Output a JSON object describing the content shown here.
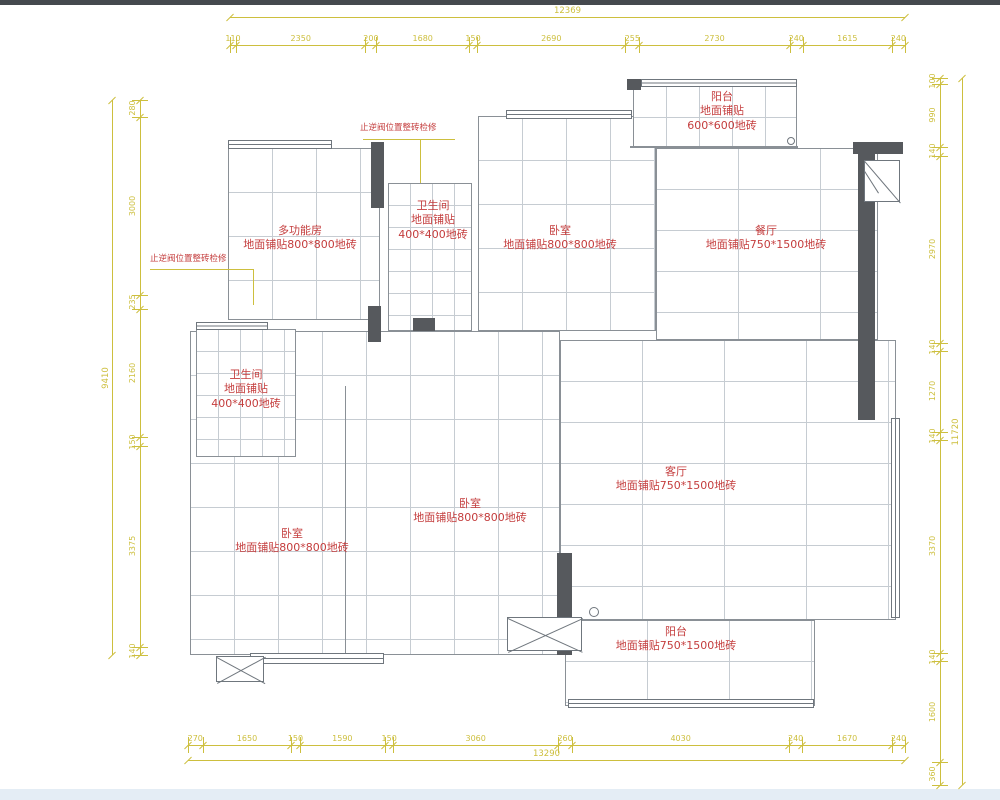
{
  "colors": {
    "dim": "#cdbf3e",
    "label": "#c43d3d",
    "wall": "#56595d",
    "grid": "#c6ccd2",
    "border": "#8a9096",
    "window_line": "#6f767d",
    "page_top_bar": "#45494e",
    "page_bottom_strip": "#e4edf5"
  },
  "dims": {
    "top": {
      "overall": "12369",
      "segments": [
        "110",
        "2350",
        "200",
        "1680",
        "150",
        "2690",
        "255",
        "2730",
        "240",
        "1615",
        "240"
      ],
      "x0": 230,
      "x1": 905,
      "seg_y": 45,
      "ov_y": 17
    },
    "bottom": {
      "overall": "13290",
      "segments": [
        "270",
        "1650",
        "150",
        "1590",
        "150",
        "3060",
        "260",
        "4030",
        "240",
        "1670",
        "240"
      ],
      "x0": 188,
      "x1": 905,
      "seg_y": 745,
      "ov_y": 760
    },
    "left": {
      "overall": "9410",
      "segments": [
        "280",
        "3000",
        "235",
        "2160",
        "150",
        "3375",
        "140"
      ],
      "y0": 100,
      "y1": 655,
      "seg_x": 140,
      "ov_x": 112
    },
    "right": {
      "overall": "11720",
      "segments": [
        "100",
        "990",
        "140",
        "2970",
        "140",
        "1270",
        "140",
        "3370",
        "140",
        "1600",
        "360"
      ],
      "y0": 78,
      "y1": 785,
      "seg_x": 940,
      "ov_x": 962
    }
  },
  "rooms": [
    {
      "id": "multi-function-room",
      "tile": "800*800",
      "x": 228,
      "y": 148,
      "w": 152,
      "h": 172
    },
    {
      "id": "bathroom-top",
      "tile": "400*400",
      "x": 388,
      "y": 183,
      "w": 84,
      "h": 148
    },
    {
      "id": "bedroom-top",
      "tile": "800*800",
      "x": 478,
      "y": 116,
      "w": 178,
      "h": 215
    },
    {
      "id": "balcony-top",
      "tile": "600*600",
      "x": 633,
      "y": 84,
      "w": 164,
      "h": 64
    },
    {
      "id": "dining-room",
      "tile": "750*1500",
      "x": 656,
      "y": 148,
      "w": 222,
      "h": 192
    },
    {
      "id": "hall-and-bedrooms",
      "tile": "800*800",
      "x": 190,
      "y": 331,
      "w": 370,
      "h": 324
    },
    {
      "id": "bathroom-left",
      "tile": "400*400",
      "x": 196,
      "y": 329,
      "w": 100,
      "h": 128
    },
    {
      "id": "living-room",
      "tile": "750*1500",
      "x": 560,
      "y": 340,
      "w": 336,
      "h": 280
    },
    {
      "id": "balcony-bottom",
      "tile": "750*1500",
      "x": 565,
      "y": 620,
      "w": 250,
      "h": 86
    }
  ],
  "room_labels": [
    {
      "x": 300,
      "y": 224,
      "lines": [
        "多功能房",
        "地面铺贴800*800地砖"
      ]
    },
    {
      "x": 433,
      "y": 199,
      "lines": [
        "卫生间",
        "地面铺贴",
        "400*400地砖"
      ]
    },
    {
      "x": 560,
      "y": 224,
      "lines": [
        "卧室",
        "地面铺贴800*800地砖"
      ]
    },
    {
      "x": 722,
      "y": 90,
      "lines": [
        "阳台",
        "地面铺贴",
        "600*600地砖"
      ]
    },
    {
      "x": 766,
      "y": 224,
      "lines": [
        "餐厅",
        "地面铺贴750*1500地砖"
      ]
    },
    {
      "x": 246,
      "y": 368,
      "lines": [
        "卫生间",
        "地面铺贴",
        "400*400地砖"
      ]
    },
    {
      "x": 292,
      "y": 527,
      "lines": [
        "卧室",
        "地面铺贴800*800地砖"
      ]
    },
    {
      "x": 470,
      "y": 497,
      "lines": [
        "卧室",
        "地面铺贴800*800地砖"
      ]
    },
    {
      "x": 676,
      "y": 465,
      "lines": [
        "客厅",
        "地面铺贴750*1500地砖"
      ]
    },
    {
      "x": 676,
      "y": 625,
      "lines": [
        "阳台",
        "地面铺贴750*1500地砖"
      ]
    }
  ],
  "notes": [
    {
      "text": "止逆阀位置整砖检修",
      "x": 360,
      "y": 124,
      "leader": [
        [
          363,
          139,
          92,
          1
        ],
        [
          420,
          139,
          1,
          44
        ]
      ]
    },
    {
      "text": "止逆阀位置整砖检修",
      "x": 150,
      "y": 255,
      "leader": [
        [
          150,
          269,
          104,
          1
        ],
        [
          253,
          269,
          1,
          36
        ]
      ]
    }
  ]
}
